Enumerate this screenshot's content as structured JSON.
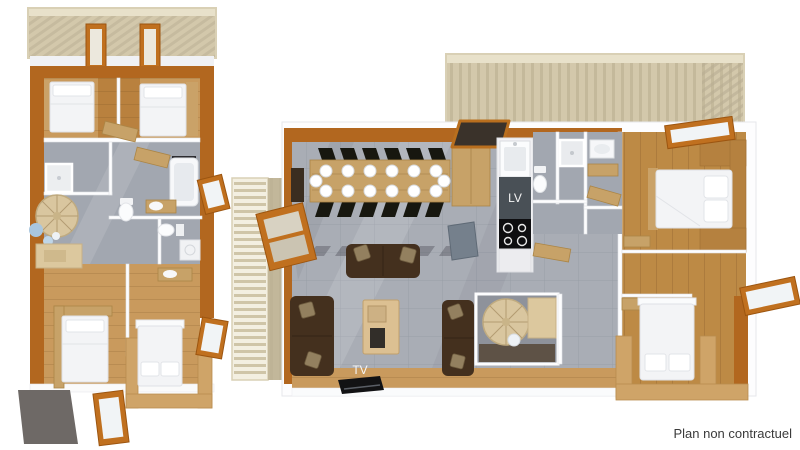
{
  "canvas": {
    "width": 800,
    "height": 450,
    "background": "#ffffff"
  },
  "labels": {
    "dishwasher": "LV",
    "tv": "TV",
    "disclaimer": "Plan non contractuel"
  },
  "dining_table": {
    "seats": 14
  },
  "palette": {
    "wallWood": "#b2671f",
    "frameOrange": "#c0701f",
    "woodFloor": "#c99a5d",
    "woodFloorDeep": "#b9813e",
    "bedroomWood": "#bd8a45",
    "tileGray": "#a9adb5",
    "bathGray": "#a2a7b0",
    "balconyDeck": "#d3c8ab",
    "balconyRail": "#e8e1ca",
    "weatheredWood": "#c2b79a",
    "whiteWall": "#fdfdfe",
    "bedWhite": "#f3f4f6",
    "sofaBrown": "#44301e",
    "pillowBeige": "#93805f",
    "tableWood": "#c7a268",
    "chairBlack": "#17170f",
    "islandBlue": "#75808c",
    "counterDark": "#495056",
    "stairWood": "#d9c69f",
    "matDark": "#6e6966",
    "textDark": "#3b3b3b",
    "labelWhite": "#f5f5f5"
  }
}
